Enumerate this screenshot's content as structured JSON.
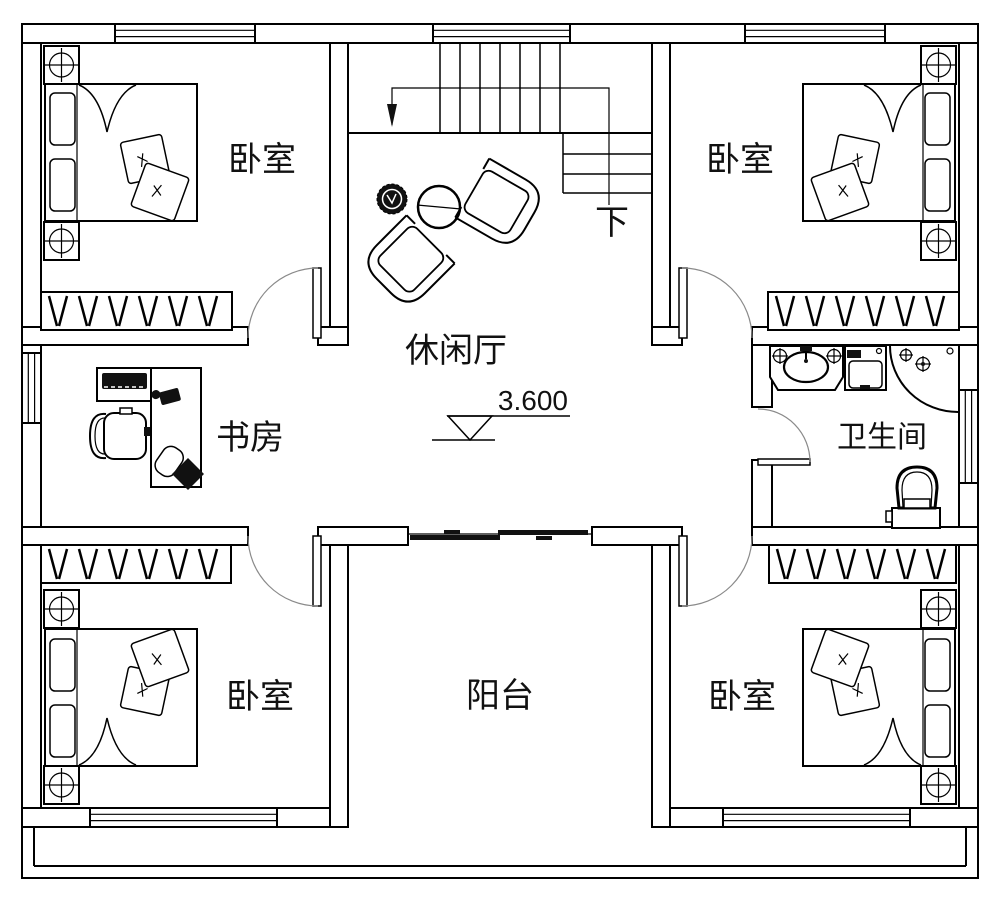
{
  "plan": {
    "rooms": {
      "bedroom_tl": "卧室",
      "bedroom_tr": "卧室",
      "bedroom_bl": "卧室",
      "bedroom_br": "卧室",
      "lounge": "休闲厅",
      "study": "书房",
      "bathroom": "卫生间",
      "balcony": "阳台"
    },
    "stairs": {
      "down_label": "下"
    },
    "level_marker": {
      "value": "3.600"
    },
    "colors": {
      "line": "#000000",
      "background": "#ffffff",
      "door_arc": "#8a8a8a",
      "solid_fill": "#111111"
    },
    "icons": {
      "bed": "bed-icon",
      "nightstand_lamp": "nightstand-lamp-icon",
      "wardrobe": "wardrobe-icon",
      "armchair": "armchair-icon",
      "coffee_table": "round-table-icon",
      "plant": "plant-icon",
      "desk": "desk-icon",
      "keyboard": "keyboard-icon",
      "office_chair": "office-chair-icon",
      "sink": "sink-icon",
      "washing_machine": "washing-machine-icon",
      "shower": "shower-icon",
      "toilet": "toilet-icon",
      "stairs": "stairs-icon",
      "swing_door": "swing-door-icon",
      "sliding_door": "sliding-door-icon",
      "window": "window-icon",
      "level_marker": "level-marker-icon"
    }
  }
}
